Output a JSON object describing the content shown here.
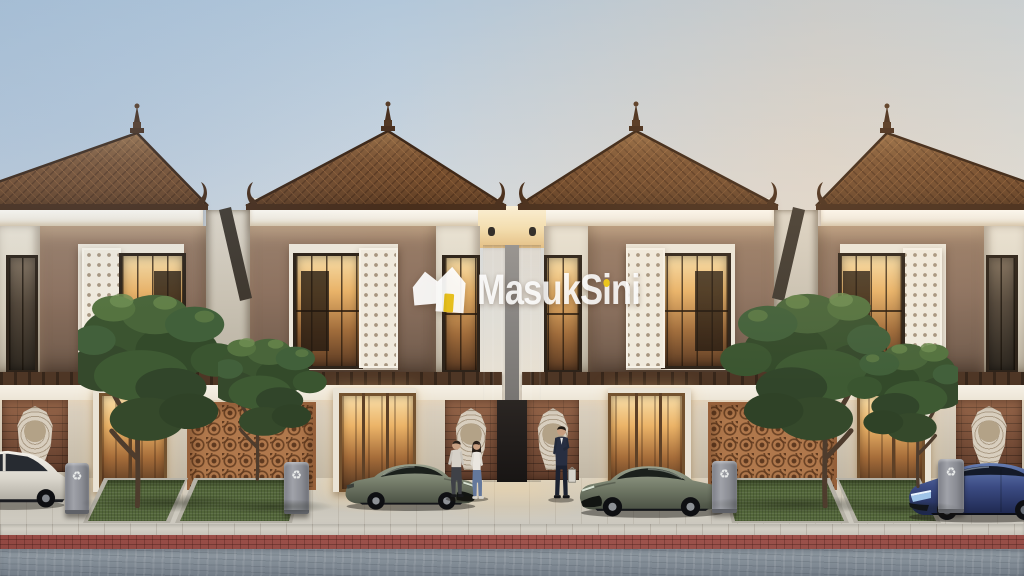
{
  "watermark": {
    "brand": "MasukSini",
    "segments": {
      "pre": "MasukS",
      "accent_i": "i",
      "mid": "n",
      "last_i": "i"
    },
    "accent_color": "#ecc51c",
    "text_color": "#ffffff"
  },
  "palette": {
    "sky_blue": "#b2c7da",
    "sky_peach": "#f2e3d0",
    "roof_brown": "#6f4829",
    "fascia_white": "#f6f1e7",
    "wall_taupe": "#8d7260",
    "wall_cream": "#d7cdbe",
    "terracotta_lattice": "#b0784c",
    "brick": "#7c4e38",
    "window_glow": "#e9b169",
    "grass": "#54663b",
    "street_gray": "#9aa5ae",
    "paver_red": "#a25048",
    "car_olive": "#77806e",
    "car_blue": "#3c4b80",
    "car_white": "#e8e5dd"
  },
  "foreground": {
    "recycle_glyph": "♻"
  }
}
